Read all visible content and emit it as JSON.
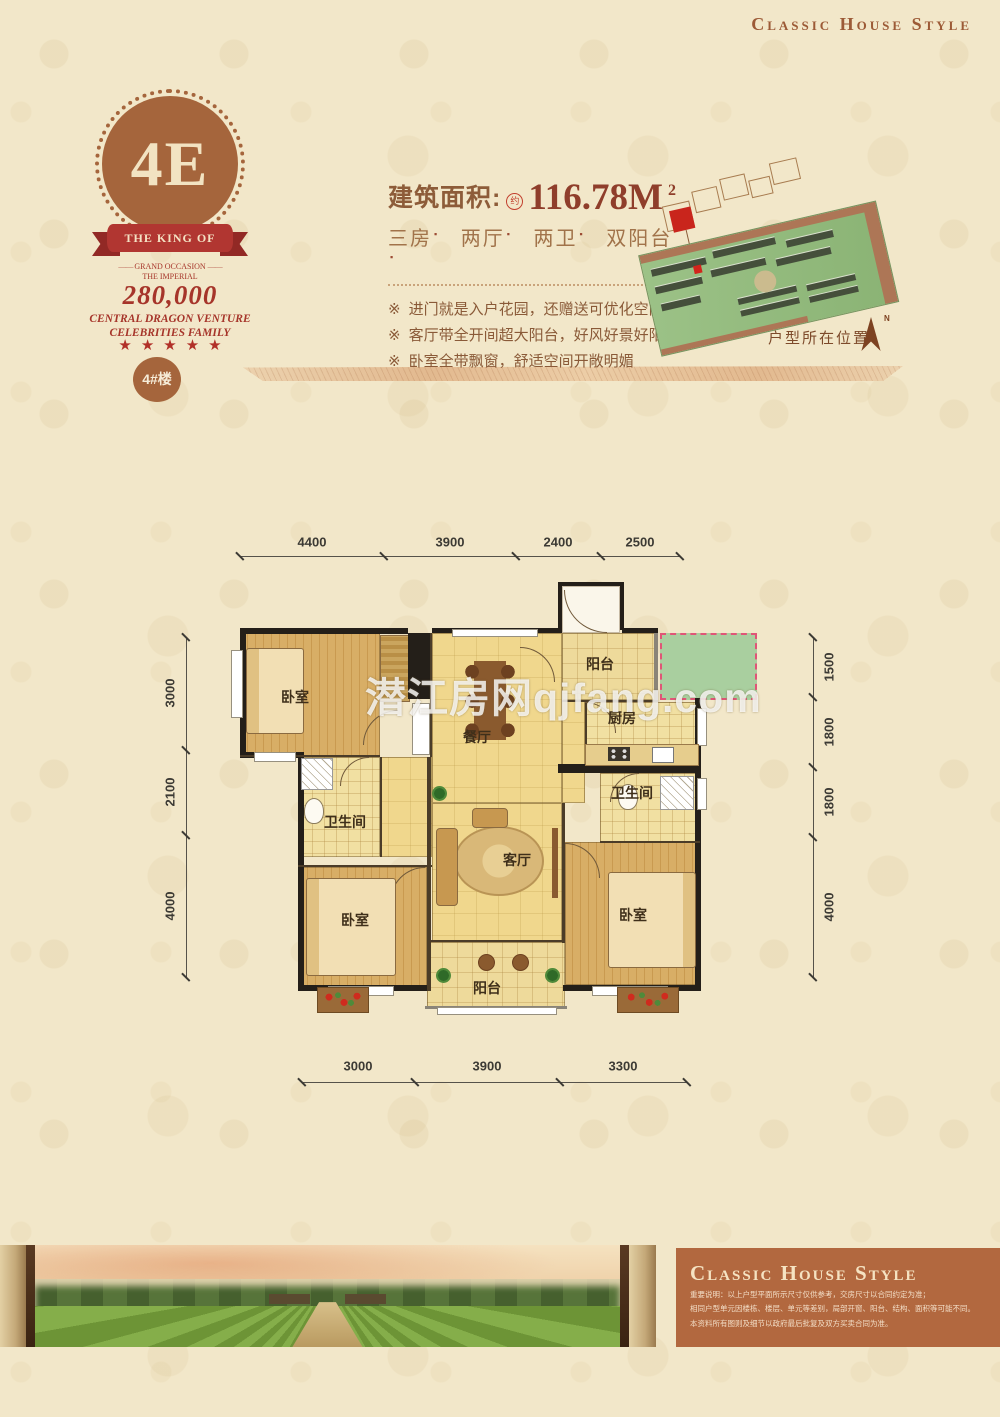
{
  "header": {
    "title": "Classic House Style"
  },
  "badge": {
    "unit_code": "4E",
    "ribbon_text": "THE KING OF CITY",
    "ornament": "——",
    "occasion_line1": "GRAND OCCASION",
    "occasion_line2": "THE IMPERIAL",
    "price_number": "280,000",
    "tagline_line1": "CENTRAL DRAGON VENTURE",
    "tagline_line2": "CELEBRITIES FAMILY",
    "stars": "★★★★★",
    "building_label": "4#楼"
  },
  "info": {
    "area_label": "建筑面积:",
    "area_stamp": "约",
    "area_value": "116.78M",
    "area_exponent": "2",
    "units": [
      "三房",
      "两厅",
      "两卫",
      "双阳台"
    ],
    "feature_bullet": "※",
    "features": [
      "进门就是入户花园，还赠送可优化空间",
      "客厅带全开间超大阳台，好风好景好阳光",
      "卧室全带飘窗，舒适空间开敞明媚"
    ]
  },
  "siteplan": {
    "caption": "户型所在位置",
    "compass_label": "N"
  },
  "floorplan": {
    "watermark": "潜江房网qjfang.com",
    "rooms": [
      {
        "name": "bedroom-top-left",
        "label": "卧室"
      },
      {
        "name": "dining-room",
        "label": "餐厅"
      },
      {
        "name": "balcony-top",
        "label": "阳台"
      },
      {
        "name": "kitchen",
        "label": "厨房"
      },
      {
        "name": "bathroom-right",
        "label": "卫生间"
      },
      {
        "name": "living-room",
        "label": "客厅"
      },
      {
        "name": "bathroom-left",
        "label": "卫生间"
      },
      {
        "name": "bedroom-bottom-left",
        "label": "卧室"
      },
      {
        "name": "bedroom-bottom-right",
        "label": "卧室"
      },
      {
        "name": "balcony-bottom",
        "label": "阳台"
      }
    ],
    "dimensions": {
      "top": [
        "4400",
        "3900",
        "2400",
        "2500"
      ],
      "bottom": [
        "3000",
        "3900",
        "3300"
      ],
      "left": [
        "3000",
        "2100",
        "4000"
      ],
      "right": [
        "1500",
        "1800",
        "1800",
        "4000"
      ]
    }
  },
  "footer": {
    "title": "Classic House Style",
    "disclaimer": [
      "重要说明：以上户型平面所示尺寸仅供参考，交房尺寸以合同约定为准；",
      "相同户型单元因楼栋、楼层、单元等差别，局部开窗、阳台、结构、面积等可能不同。",
      "本资料所有图则及细节以政府最后批复及双方买卖合同为准。"
    ]
  },
  "colors": {
    "badge_brown": "#a5653c",
    "ribbon_red": "#b13631",
    "accent_red": "#a6352a",
    "gift_green": "#a9cf9f",
    "footer_brown": "#b2683f"
  }
}
